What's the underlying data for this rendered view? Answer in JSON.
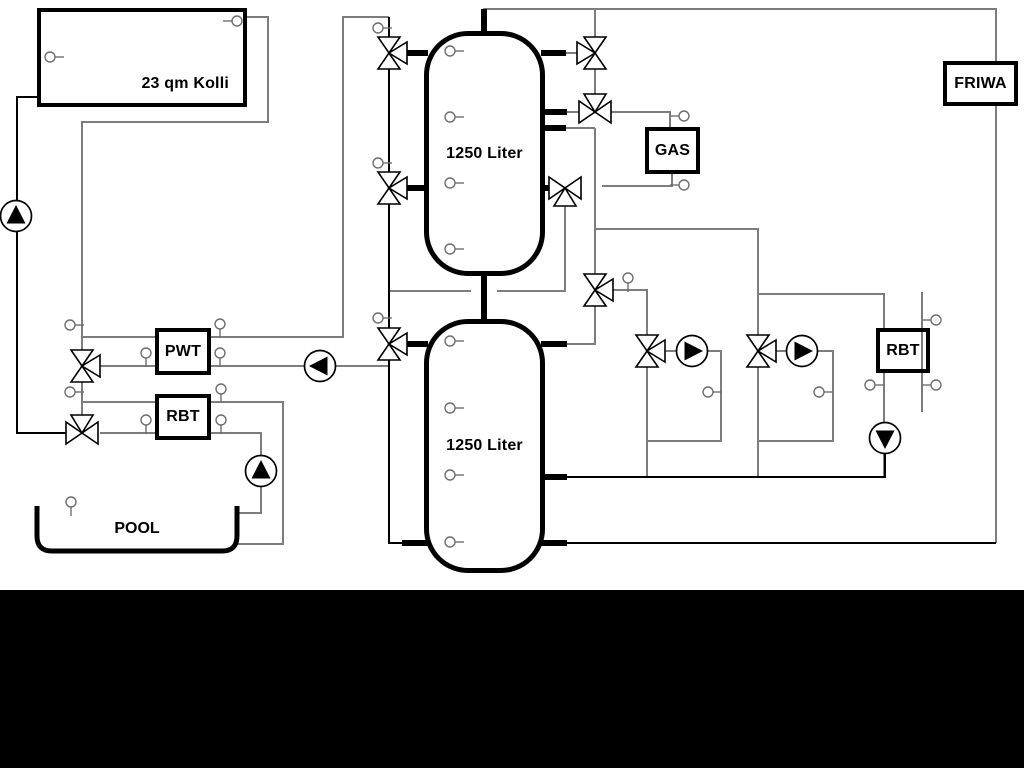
{
  "diagram": {
    "background": "#ffffff",
    "bottom_bar_color": "#000000",
    "line_colors": {
      "gray": "#7d7d7d",
      "black": "#000000"
    },
    "icon_names": [
      "pump-icon",
      "three-way-valve-icon",
      "temperature-sensor-icon"
    ],
    "components": {
      "collector": {
        "label": "23 qm Kolli"
      },
      "tank_top": {
        "label": "1250 Liter"
      },
      "tank_bottom": {
        "label": "1250 Liter"
      },
      "pwt": {
        "label": "PWT"
      },
      "rbt_pool": {
        "label": "RBT"
      },
      "gas": {
        "label": "GAS"
      },
      "friwa": {
        "label": "FRIWA"
      },
      "rbt_right": {
        "label": "RBT"
      },
      "pool": {
        "label": "POOL"
      }
    }
  }
}
